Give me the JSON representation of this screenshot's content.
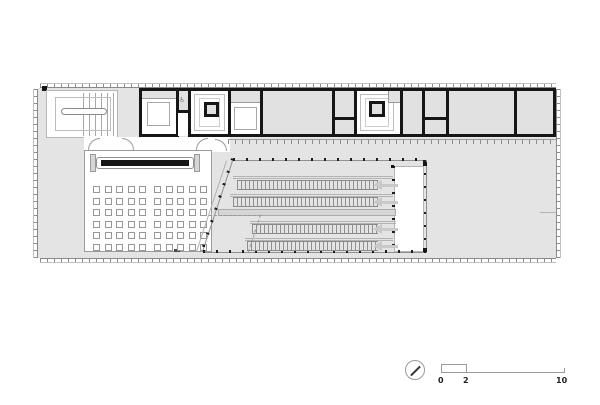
{
  "drawing": {
    "kind_label": "architectural floor plan",
    "colors": {
      "wall": "#161616",
      "floor": "#e4e4e4",
      "line": "#9a9a9a",
      "arrow": "#c9c9c9"
    },
    "lecture_room": {
      "seat_rows": 6,
      "seat_cols_left": 5,
      "seat_cols_right": 5
    },
    "stair_hall": {
      "flights": 4
    },
    "icons": {
      "north_arrow": "north-arrow-icon",
      "wheelchair_glyph": "♿"
    }
  },
  "scale_bar": {
    "labels": [
      "0",
      "2",
      "10"
    ]
  }
}
